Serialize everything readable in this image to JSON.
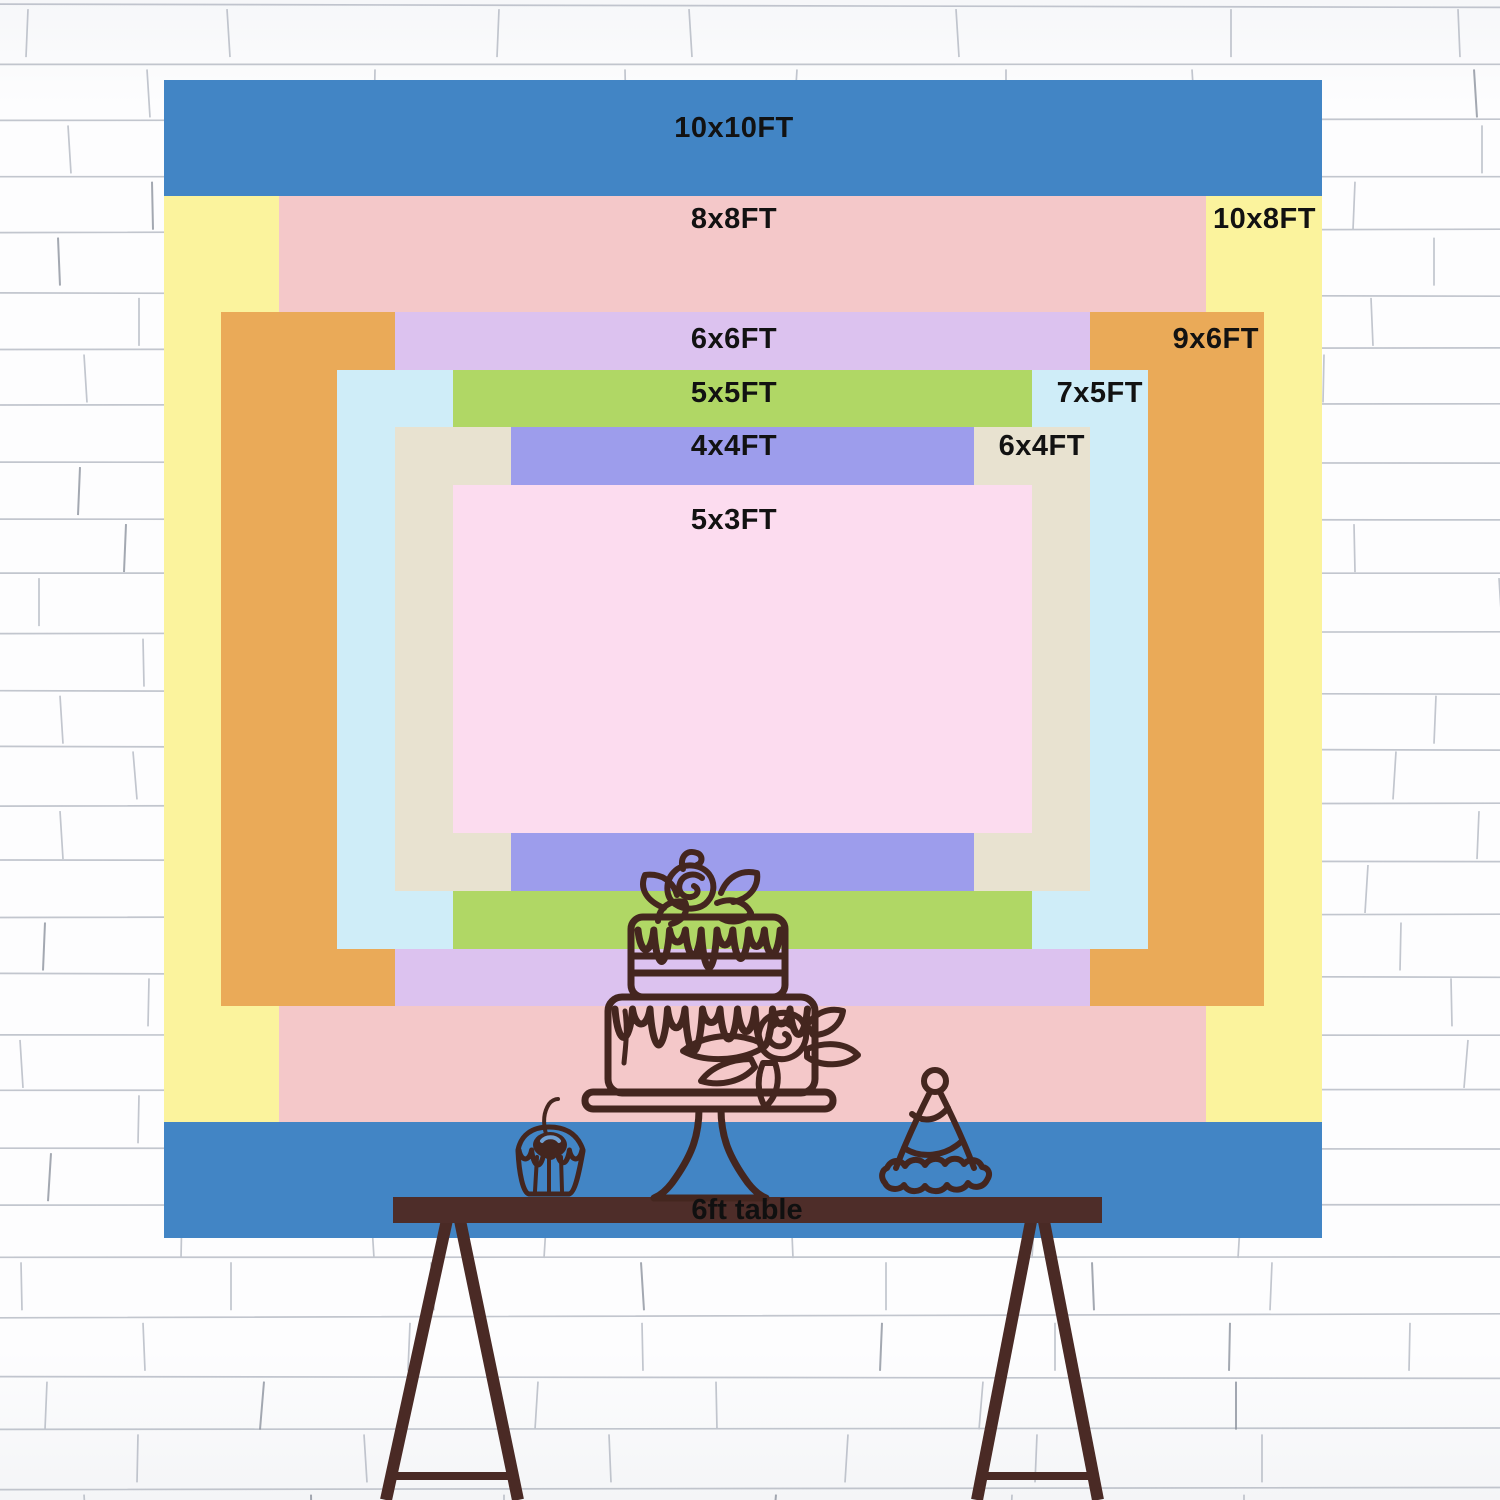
{
  "backdrop_chart": {
    "unit": "FT",
    "label_color": "#121212",
    "layers": [
      {
        "label": "10x10FT",
        "width_ft": 10,
        "height_ft": 10,
        "color": "#4285c5",
        "label_pos": "center"
      },
      {
        "label": "10x8FT",
        "width_ft": 10,
        "height_ft": 8,
        "color": "#fbf39d",
        "label_pos": "right-strip"
      },
      {
        "label": "8x8FT",
        "width_ft": 8,
        "height_ft": 8,
        "color": "#f4c8c9",
        "label_pos": "center"
      },
      {
        "label": "9x6FT",
        "width_ft": 9,
        "height_ft": 6,
        "color": "#eaaa58",
        "label_pos": "right-strip"
      },
      {
        "label": "6x6FT",
        "width_ft": 6,
        "height_ft": 6,
        "color": "#dcc2ef",
        "label_pos": "center"
      },
      {
        "label": "7x5FT",
        "width_ft": 7,
        "height_ft": 5,
        "color": "#cfedf8",
        "label_pos": "right-strip"
      },
      {
        "label": "5x5FT",
        "width_ft": 5,
        "height_ft": 5,
        "color": "#b0d765",
        "label_pos": "center"
      },
      {
        "label": "6x4FT",
        "width_ft": 6,
        "height_ft": 4,
        "color": "#e8e2d0",
        "label_pos": "right-strip"
      },
      {
        "label": "4x4FT",
        "width_ft": 4,
        "height_ft": 4,
        "color": "#9d9dec",
        "label_pos": "center"
      },
      {
        "label": "5x3FT",
        "width_ft": 5,
        "height_ft": 3,
        "color": "#fcdcef",
        "label_pos": "center"
      }
    ],
    "table": {
      "label": "6ft table",
      "bar_color": "#4e2d29"
    },
    "illustration_color": "#44261f"
  }
}
